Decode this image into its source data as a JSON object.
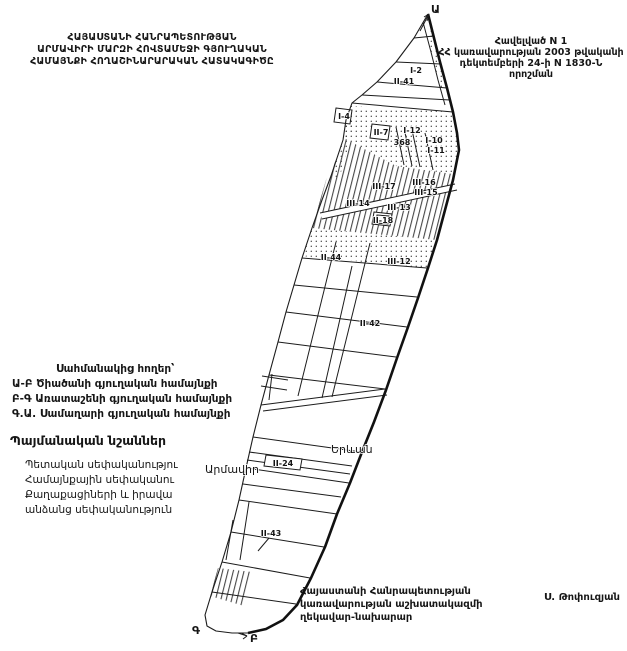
{
  "header": {
    "left_lines": [
      "ՀԱՅԱՍՏԱՆԻ ՀԱՆՐԱՊԵՏՈՒԹՅԱՆ",
      "ԱՐՄԱՎԻՐԻ ՄԱՐԶԻ ՀՈՎՏԱՄԵՋԻ ԳՅՈՒՂԱԿԱՆ",
      "ՀԱՄԱՅՆՔԻ ՀՈՂԱՇԻՆԱՐԱՐԱԿԱՆ ՀԱՏԱԿԱԳԻԾԸ"
    ],
    "right_lines": [
      "Հավելված N 1",
      "ՀՀ կառավարության 2003 թվականի",
      "դեկտեմբերի 24-ի N 1830-Ն որոշման"
    ]
  },
  "adjacent_lands": {
    "heading": "Սահմանակից հողեր՝",
    "items": [
      "Ա-Բ Ծիածանի գյուղական համայնքի",
      "Բ-Գ Առատաշենի գյուղական համայնքի",
      "Գ.Ա. Սամաղարի գյուղական համայնքի"
    ]
  },
  "legend": {
    "heading": "Պայմանական նշաններ",
    "items": [
      "Պետական սեփականությու",
      "Համայնքային սեփականու",
      "Քաղաքացիների և իրավա",
      "անձանց սեփականություն"
    ]
  },
  "signature": {
    "lines": [
      "Հայաստանի Հանրապետության",
      "կառավարության աշխատակազմի",
      "ղեկավար-նախարար"
    ],
    "name": "Ս. Թոփուզյան"
  },
  "map": {
    "boundary_points": [
      "Ա",
      "Գ",
      "Բ"
    ],
    "places": [
      "Արմավիր",
      "Երևան"
    ],
    "parcels": [
      "I-2",
      "II-41",
      "I-4",
      "II-7",
      "I-12",
      "368",
      "I-10",
      "I-11",
      "III-17",
      "III-16",
      "III-15",
      "III-14",
      "III-13",
      "II-18",
      "II-44",
      "III-12",
      "II-42",
      "II-24",
      "II-43"
    ]
  },
  "colors": {
    "ink": "#161616",
    "paper": "#ffffff"
  }
}
